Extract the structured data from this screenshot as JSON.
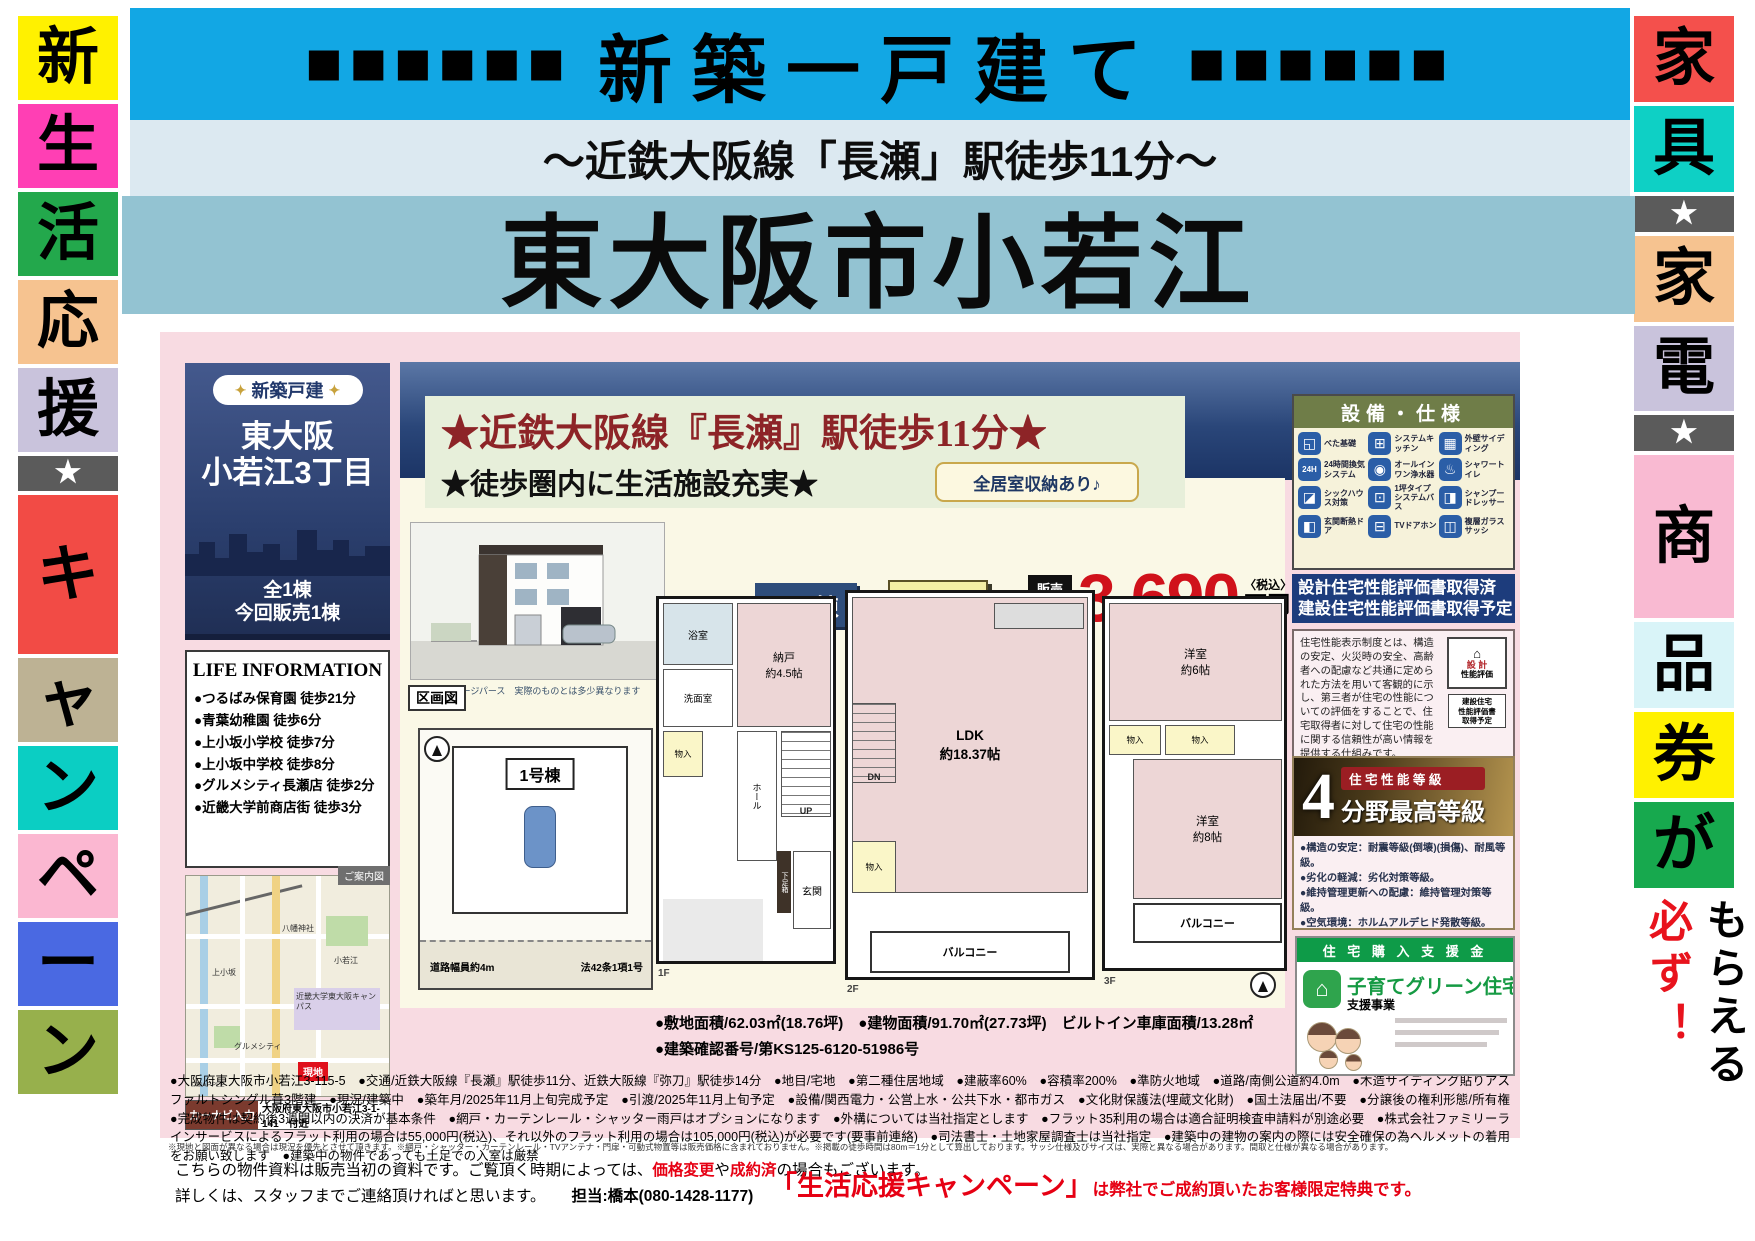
{
  "banner": {
    "squares_left": "■■■■■■",
    "title": "新築一戸建て",
    "squares_right": "■■■■■■",
    "subtitle": "～近鉄大阪線「長瀬」駅徒歩11分～",
    "main_title": "東大阪市小若江"
  },
  "left_banner": {
    "cells": [
      {
        "ch": "新",
        "bg": "#FFF100"
      },
      {
        "ch": "生",
        "bg": "#FF3FB4"
      },
      {
        "ch": "活",
        "bg": "#23A84C"
      },
      {
        "ch": "応",
        "bg": "#F6C390"
      },
      {
        "ch": "援",
        "bg": "#C9C3DC"
      },
      {
        "ch": "★",
        "bg": "#5B5B5B",
        "star": true
      },
      {
        "ch": "キ",
        "bg": "#F24B45",
        "tall": true
      },
      {
        "ch": "ャ",
        "bg": "#BDB294"
      },
      {
        "ch": "ン",
        "bg": "#0BCEC3"
      },
      {
        "ch": "ペ",
        "bg": "#FBB7D1"
      },
      {
        "ch": "ー",
        "bg": "#4A69E2"
      },
      {
        "ch": "ン",
        "bg": "#97B04C"
      }
    ]
  },
  "right_banner": {
    "cells": [
      {
        "ch": "家",
        "bg": "#F4504C"
      },
      {
        "ch": "具",
        "bg": "#0ED0C5"
      },
      {
        "ch": "★",
        "bg": "#5B5B5B",
        "star": true
      },
      {
        "ch": "家",
        "bg": "#F6C390"
      },
      {
        "ch": "電",
        "bg": "#C9C3DC"
      },
      {
        "ch": "★",
        "bg": "#5B5B5B",
        "star": true
      },
      {
        "ch": "商",
        "bg": "#F9BAD2",
        "tall": true
      },
      {
        "ch": "品",
        "bg": "#D9F4F8"
      },
      {
        "ch": "券",
        "bg": "#FFF100"
      },
      {
        "ch": "が",
        "bg": "#17A94E"
      }
    ],
    "must": "必ず！",
    "get": "もらえる"
  },
  "left_panel": {
    "badge_deco": "✦",
    "badge": "新築戸建",
    "area_line1": "東大阪",
    "area_line2": "小若江3丁目",
    "units_line1": "全1棟",
    "units_line2": "今回販売1棟",
    "life_title": "LIFE INFORMATION",
    "life_items": [
      "●つるばみ保育園 徒歩21分",
      "●青葉幼稚園 徒歩6分",
      "●上小坂小学校 徒歩7分",
      "●上小坂中学校 徒歩8分",
      "●グルメシティ長瀬店 徒歩2分",
      "●近畿大学前商店街 徒歩3分"
    ],
    "map_tab": "ご案内図",
    "map_labels": [
      "八幡神社",
      "上小坂",
      "近畿大学東大阪キャンパス",
      "グルメシティ",
      "現地",
      "©MAPPLE",
      "小若江"
    ],
    "navi_label": "カーナビ入力",
    "navi_address": "大阪府東大阪市小若江3-1-141　付近"
  },
  "main": {
    "headline1": "★近鉄大阪線『長瀬』駅徒歩11分★",
    "headline2": "★徒歩圏内に生活施設充実★",
    "render_caption": "※イメージパース　実際のものとは多少異なります",
    "storage_badge": "全居室収納あり♪",
    "building": "A号棟",
    "layout": "2SLDK",
    "price_label1": "販売",
    "price_label2": "価格",
    "price_value": "3,690",
    "price_tax": "〈税込〉",
    "price_unit": "万円",
    "areas_line1": "●敷地面積/62.03㎡(18.76坪)　●建物面積/91.70㎡(27.73坪)　ビルトイン車庫面積/13.28㎡",
    "areas_line2": "●建築確認番号/第KS125-6120-51986号",
    "details": "●大阪府東大阪市小若江3-115-5　●交通/近鉄大阪線『長瀬』駅徒歩11分、近鉄大阪線『弥刀』駅徒歩14分　●地目/宅地　●第二種住居地域　●建蔽率60%　●容積率200%　●準防火地域　●道路/南側公道約4.0m　●木造サイディング貼りアスファルトシングル葺3階建　●現況/建築中　●築年月/2025年11月上旬完成予定　●引渡/2025年11月上旬予定　●設備/関西電力・公営上水・公共下水・都市ガス　●文化財保護法(埋蔵文化財)　●国土法届出/不要　●分譲後の権利形態/所有権　●完成物件は契約後3週間以内の決済が基本条件　●網戸・カーテンレール・シャッター雨戸はオプションになります　●外構については当社指定とします　●フラット35利用の場合は適合証明検査申請料が別途必要　●株式会社ファミリーラインサービスによるフラット利用の場合は55,000円(税込)、それ以外のフラット利用の場合は105,000円(税込)が必要です(要事前連絡)　●司法書士・土地家屋調査士は当社指定　●建築中の建物の案内の際には安全確保の為ヘルメットの着用をお願い致します　●建築中の物件であっても土足での入室は厳禁",
    "fine_print": "※現地と図面が異なる場合は現況を優先とさせて頂きます。※網戸・シャッター・カーテンレール・TVアンテナ・門扉・可動式物置等は販売価格に含まれておりません。※掲載の徒歩時間は80m＝1分として算出しております。サッシ仕様及びサイズは、実際と異なる場合があります。間取と仕様が異なる場合があります。"
  },
  "plans": {
    "plot_tag": "区画図",
    "plot_name": "1号棟",
    "plot_road": "道路幅員約4m",
    "plot_law": "法42条1項1号",
    "f1": {
      "bath": "浴室",
      "wash": "洗面室",
      "nando": "納戸\n約4.5帖",
      "closet": "物入",
      "hall": "ホール",
      "up": "UP",
      "genkan": "玄関",
      "shoe": "下足箱",
      "tag": "1F"
    },
    "f2": {
      "ldk": "LDK\n約18.37帖",
      "dn": "DN",
      "closet": "物入",
      "balcony": "バルコニー",
      "tag": "2F"
    },
    "f3": {
      "room6": "洋室\n約6帖",
      "closet1": "物入",
      "closet2": "物入",
      "room8": "洋室\n約8帖",
      "balcony": "バルコニー",
      "tag": "3F"
    }
  },
  "right_panel": {
    "equip_title": "設備・仕様",
    "equip_items": [
      {
        "glyph": "◱",
        "label": "べた基礎"
      },
      {
        "glyph": "⊞",
        "label": "システムキッチン"
      },
      {
        "glyph": "▦",
        "label": "外壁サイディング"
      },
      {
        "glyph": "24H",
        "label": "24時間換気システム"
      },
      {
        "glyph": "◉",
        "label": "オールインワン浄水器"
      },
      {
        "glyph": "♨",
        "label": "シャワートイレ"
      },
      {
        "glyph": "◪",
        "label": "シックハウス対策"
      },
      {
        "glyph": "⊡",
        "label": "1坪タイプシステムバス"
      },
      {
        "glyph": "◨",
        "label": "シャンプードレッサー"
      },
      {
        "glyph": "◧",
        "label": "玄関断熱ドア"
      },
      {
        "glyph": "⊟",
        "label": "TVドアホン"
      },
      {
        "glyph": "◫",
        "label": "複層ガラスサッシ"
      }
    ],
    "eval_line1": "設計住宅性能評価書取得済",
    "eval_line2": "建設住宅性能評価書取得予定",
    "eval_desc": "住宅性能表示制度とは、構造の安定、火災時の安全、高齢者への配慮など共通に定められた方法を用いて客観的に示し、第三者が住宅の性能についての評価をすることで、住宅取得者に対して住宅の性能に関する信頼性が高い情報を提供する仕組みです。",
    "stamp1_house": "⌂",
    "stamp1a": "設 計",
    "stamp1b": "性能評価",
    "stamp2": "建設住宅\n性能評価書\n取得予定",
    "grade_num": "4",
    "grade_label": "住 宅 性 能 等 級",
    "grade_text": "分野最高等級",
    "grade_items": [
      "●構造の安定：耐震等級(倒壊)(損傷)、耐風等級。",
      "●劣化の軽減：劣化対策等級。",
      "●維持管理更新への配慮：維持管理対策等級。",
      "●空気環境：ホルムアルデヒド発散等級。"
    ],
    "support_banner": "住 宅 購 入 支 援 金",
    "support_house": "⌂",
    "support_title": "子育てグリーン住宅",
    "support_sub": "支援事業"
  },
  "footer": {
    "note1a": "こちらの物件資料は販売当初の資料です。ご覧頂く時期によっては、",
    "note1_red1": "価格変更",
    "note1b": "や",
    "note1_red2": "成約済",
    "note1c": "の場合もございます。",
    "note2": "詳しくは、スタッフまでご連絡頂ければと思います。",
    "contact": "担当:橋本(080-1428-1177)",
    "campaign_big": "「生活応援キャンペーン」",
    "campaign_rest": "は弊社でご成約頂いたお客様限定特典です。"
  }
}
